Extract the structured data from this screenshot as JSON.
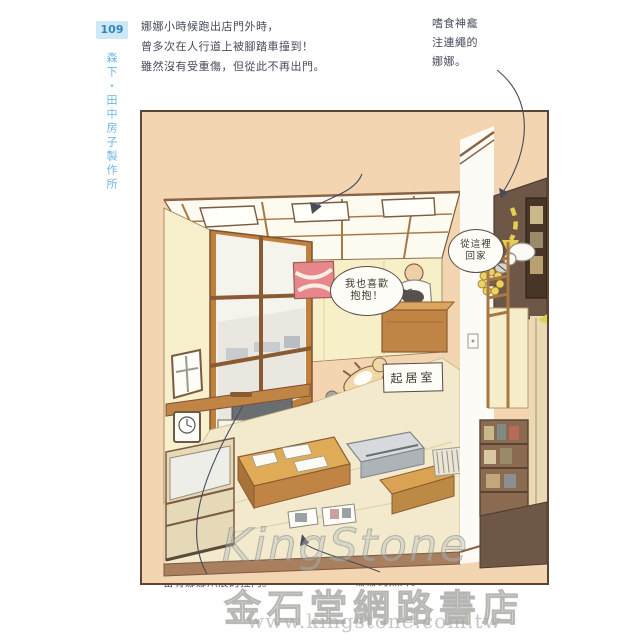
{
  "sidebar": {
    "page_number": "109",
    "book_title": "森下・田中房子製作所"
  },
  "captions": {
    "intro": {
      "lines": [
        "娜娜小時候跑出店門外時，",
        "曾多次在人行道上被腳踏車撞到！",
        "雖然沒有受重傷，但從此不再出門。"
      ]
    },
    "top_right": {
      "lines": [
        "嗜食神龕",
        "注連繩的",
        "娜娜。"
      ]
    },
    "tanaka": {
      "lines": [
        "被選為深川神明宮總代表的田中先生。",
        "牆上掛著廟會時的照片。"
      ]
    },
    "bottom_left": "留有娜娜爪痕的拉門。",
    "bottom_right": "娜娜的照片。"
  },
  "speech_bubbles": {
    "grandpa": {
      "lines": [
        "我也喜歡",
        "抱抱！"
      ]
    },
    "cat_return": {
      "lines": [
        "從這裡",
        "回家"
      ]
    }
  },
  "labels": {
    "room": "起居室"
  },
  "watermark": {
    "brand": "KingStone",
    "store": "金石堂網路書店",
    "url": "www.kingstone.com.tw"
  },
  "colors": {
    "sidebar_blue": "#6db8e0",
    "pagenum_bg": "#cfe8f6",
    "handwriting": "#474b5a",
    "panel_background": "#f3d5b1",
    "panel_border": "#5f4533",
    "wall_cream": "#f8f0cc",
    "wood": "#c0803d",
    "dark_wall": "#6e5746",
    "festival_photo_pink": "#e8878b",
    "arrow_yellow": "#e5cf4e"
  }
}
